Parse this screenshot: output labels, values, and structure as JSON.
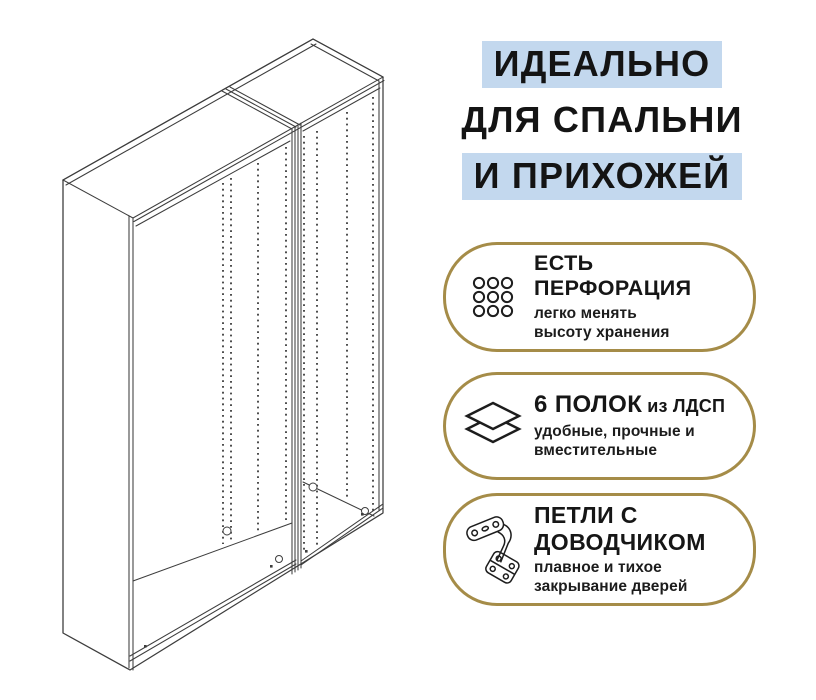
{
  "canvas": {
    "width": 816,
    "height": 700,
    "background": "#ffffff"
  },
  "colors": {
    "highlight_blue": "#c3d8ee",
    "badge_border_gold": "#a58c48",
    "text_dark": "#161616",
    "line_art": "#3d3d3d"
  },
  "illustration": {
    "name": "wardrobe-frame-line-drawing",
    "sections": 2
  },
  "headline": {
    "lines": [
      {
        "text": "ИДЕАЛЬНО",
        "highlighted": true
      },
      {
        "text": "ДЛЯ СПАЛЬНИ",
        "highlighted": false
      },
      {
        "text": "И ПРИХОЖЕЙ",
        "highlighted": true
      }
    ]
  },
  "badges": [
    {
      "icon": "perforation-grid-icon",
      "title_lines": [
        "ЕСТЬ",
        "ПЕРФОРАЦИЯ"
      ],
      "subtitle_lines": [
        "легко менять",
        "высоту хранения"
      ]
    },
    {
      "icon": "shelves-layers-icon",
      "title_main": "6 ПОЛОК",
      "title_suffix": "из ЛДСП",
      "subtitle_lines": [
        "удобные, прочные и",
        "вместительные"
      ]
    },
    {
      "icon": "hinge-icon",
      "title_lines": [
        "ПЕТЛИ С",
        "ДОВОДЧИКОМ"
      ],
      "subtitle_lines": [
        "плавное и тихое",
        "закрывание дверей"
      ]
    }
  ]
}
